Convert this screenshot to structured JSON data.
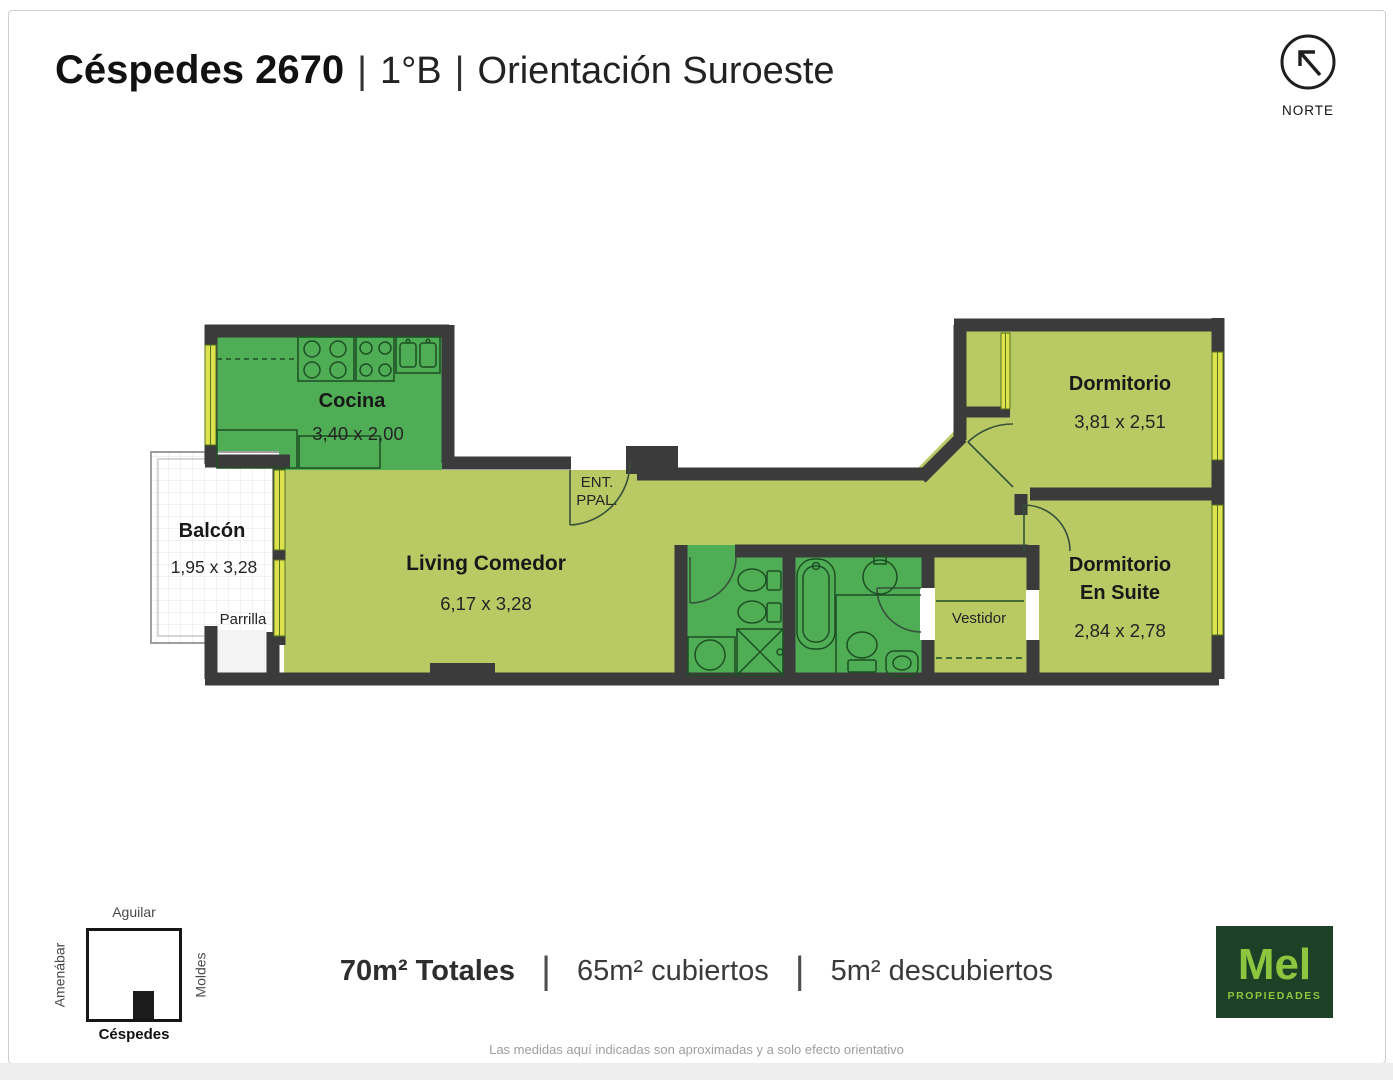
{
  "header": {
    "title": "Céspedes 2670",
    "separator": "|",
    "unit": "1°B",
    "orientation": "Orientación Suroeste"
  },
  "compass": {
    "label": "NORTE"
  },
  "plan": {
    "rooms": {
      "cocina": {
        "name": "Cocina",
        "dims": "3,40 x 2,00"
      },
      "balcon": {
        "name": "Balcón",
        "dims": "1,95 x 3,28",
        "sublabel": "Parrilla"
      },
      "living": {
        "name": "Living Comedor",
        "dims": "6,17 x 3,28"
      },
      "entrada": {
        "line1": "ENT.",
        "line2": "PPAL."
      },
      "dormitorio": {
        "name": "Dormitorio",
        "dims": "3,81 x 2,51"
      },
      "suite": {
        "name_line1": "Dormitorio",
        "name_line2": "En Suite",
        "dims": "2,84 x 2,78"
      },
      "vestidor": {
        "name": "Vestidor"
      }
    },
    "colors": {
      "wall": "#3b3b3b",
      "wet_room": "#4fae55",
      "dry_room": "#b9c964",
      "window": "#dde24f"
    }
  },
  "map": {
    "street_top": "Aguilar",
    "street_left": "Amenábar",
    "street_right": "Moldes",
    "street_bottom": "Céspedes"
  },
  "stats": {
    "total": "70m² Totales",
    "covered": "65m² cubiertos",
    "uncovered": "5m² descubiertos",
    "divider": "|"
  },
  "brand": {
    "name": "Mel",
    "tagline": "PROPIEDADES"
  },
  "footer": {
    "disclaimer": "Las medidas aquí indicadas son aproximadas y a solo efecto orientativo"
  }
}
